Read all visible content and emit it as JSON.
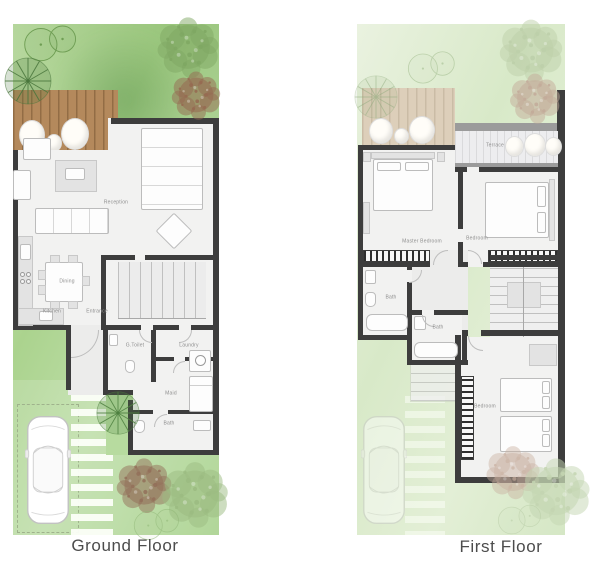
{
  "ground": {
    "caption": "Ground Floor",
    "rooms": {
      "reception": "Reception",
      "dining": "Dining",
      "kitchen": "Kitchen",
      "entrance": "Entrance",
      "g_toilet": "G.Toilet",
      "laundry": "Laundry",
      "maid": "Maid",
      "bath": "Bath"
    }
  },
  "first": {
    "caption": "First Floor",
    "rooms": {
      "terrace": "Terrace",
      "master_bedroom": "Master Bedroom",
      "bedroom_front": "Bedroom",
      "bath_master": "Bath",
      "bath_shared": "Bath",
      "bedroom_back": "Bedroom"
    }
  },
  "colors": {
    "wall": "#3d3d3d",
    "lawn": "#abd38e",
    "lawn_faded": "#dce9cc",
    "deck": "#b4895c",
    "deck_faded": "#ddcfba",
    "floor": "#f2f2f1",
    "label_text": "#8e8e8e",
    "caption_text": "#4c4c4c"
  }
}
